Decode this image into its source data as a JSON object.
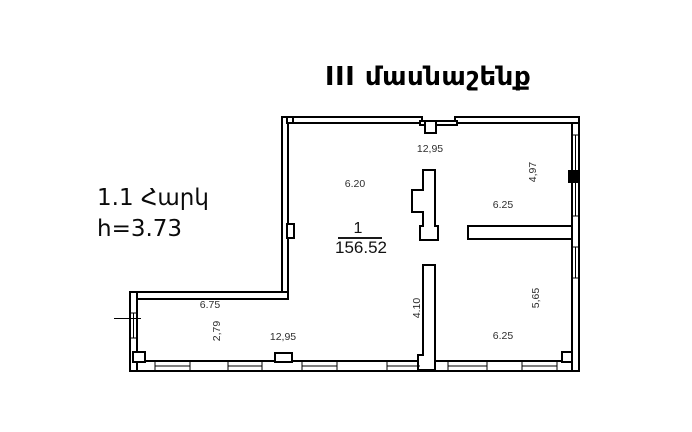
{
  "title": "III մասնաշենք",
  "floor_info": {
    "floor_label": "1.1 Հարկ",
    "height_label": "h=3.73"
  },
  "plan": {
    "room": {
      "number": "1",
      "area": "156.52"
    },
    "dimensions": [
      {
        "name": "top-width",
        "text": "12,95"
      },
      {
        "name": "hall-width",
        "text": "6.20"
      },
      {
        "name": "room-upper-right-depth",
        "text": "4,97"
      },
      {
        "name": "room-upper-right-width",
        "text": "6.25"
      },
      {
        "name": "room-lower-right-depth",
        "text": "5,65"
      },
      {
        "name": "room-lower-right-width",
        "text": "6.25"
      },
      {
        "name": "partition-length",
        "text": "4.10"
      },
      {
        "name": "strip-segment-width",
        "text": "6.75"
      },
      {
        "name": "strip-depth",
        "text": "2,79"
      },
      {
        "name": "bottom-width",
        "text": "12,95"
      }
    ],
    "colors": {
      "walls": "#000000",
      "dimension_text": "#2e2e2e",
      "background": "#ffffff"
    }
  }
}
